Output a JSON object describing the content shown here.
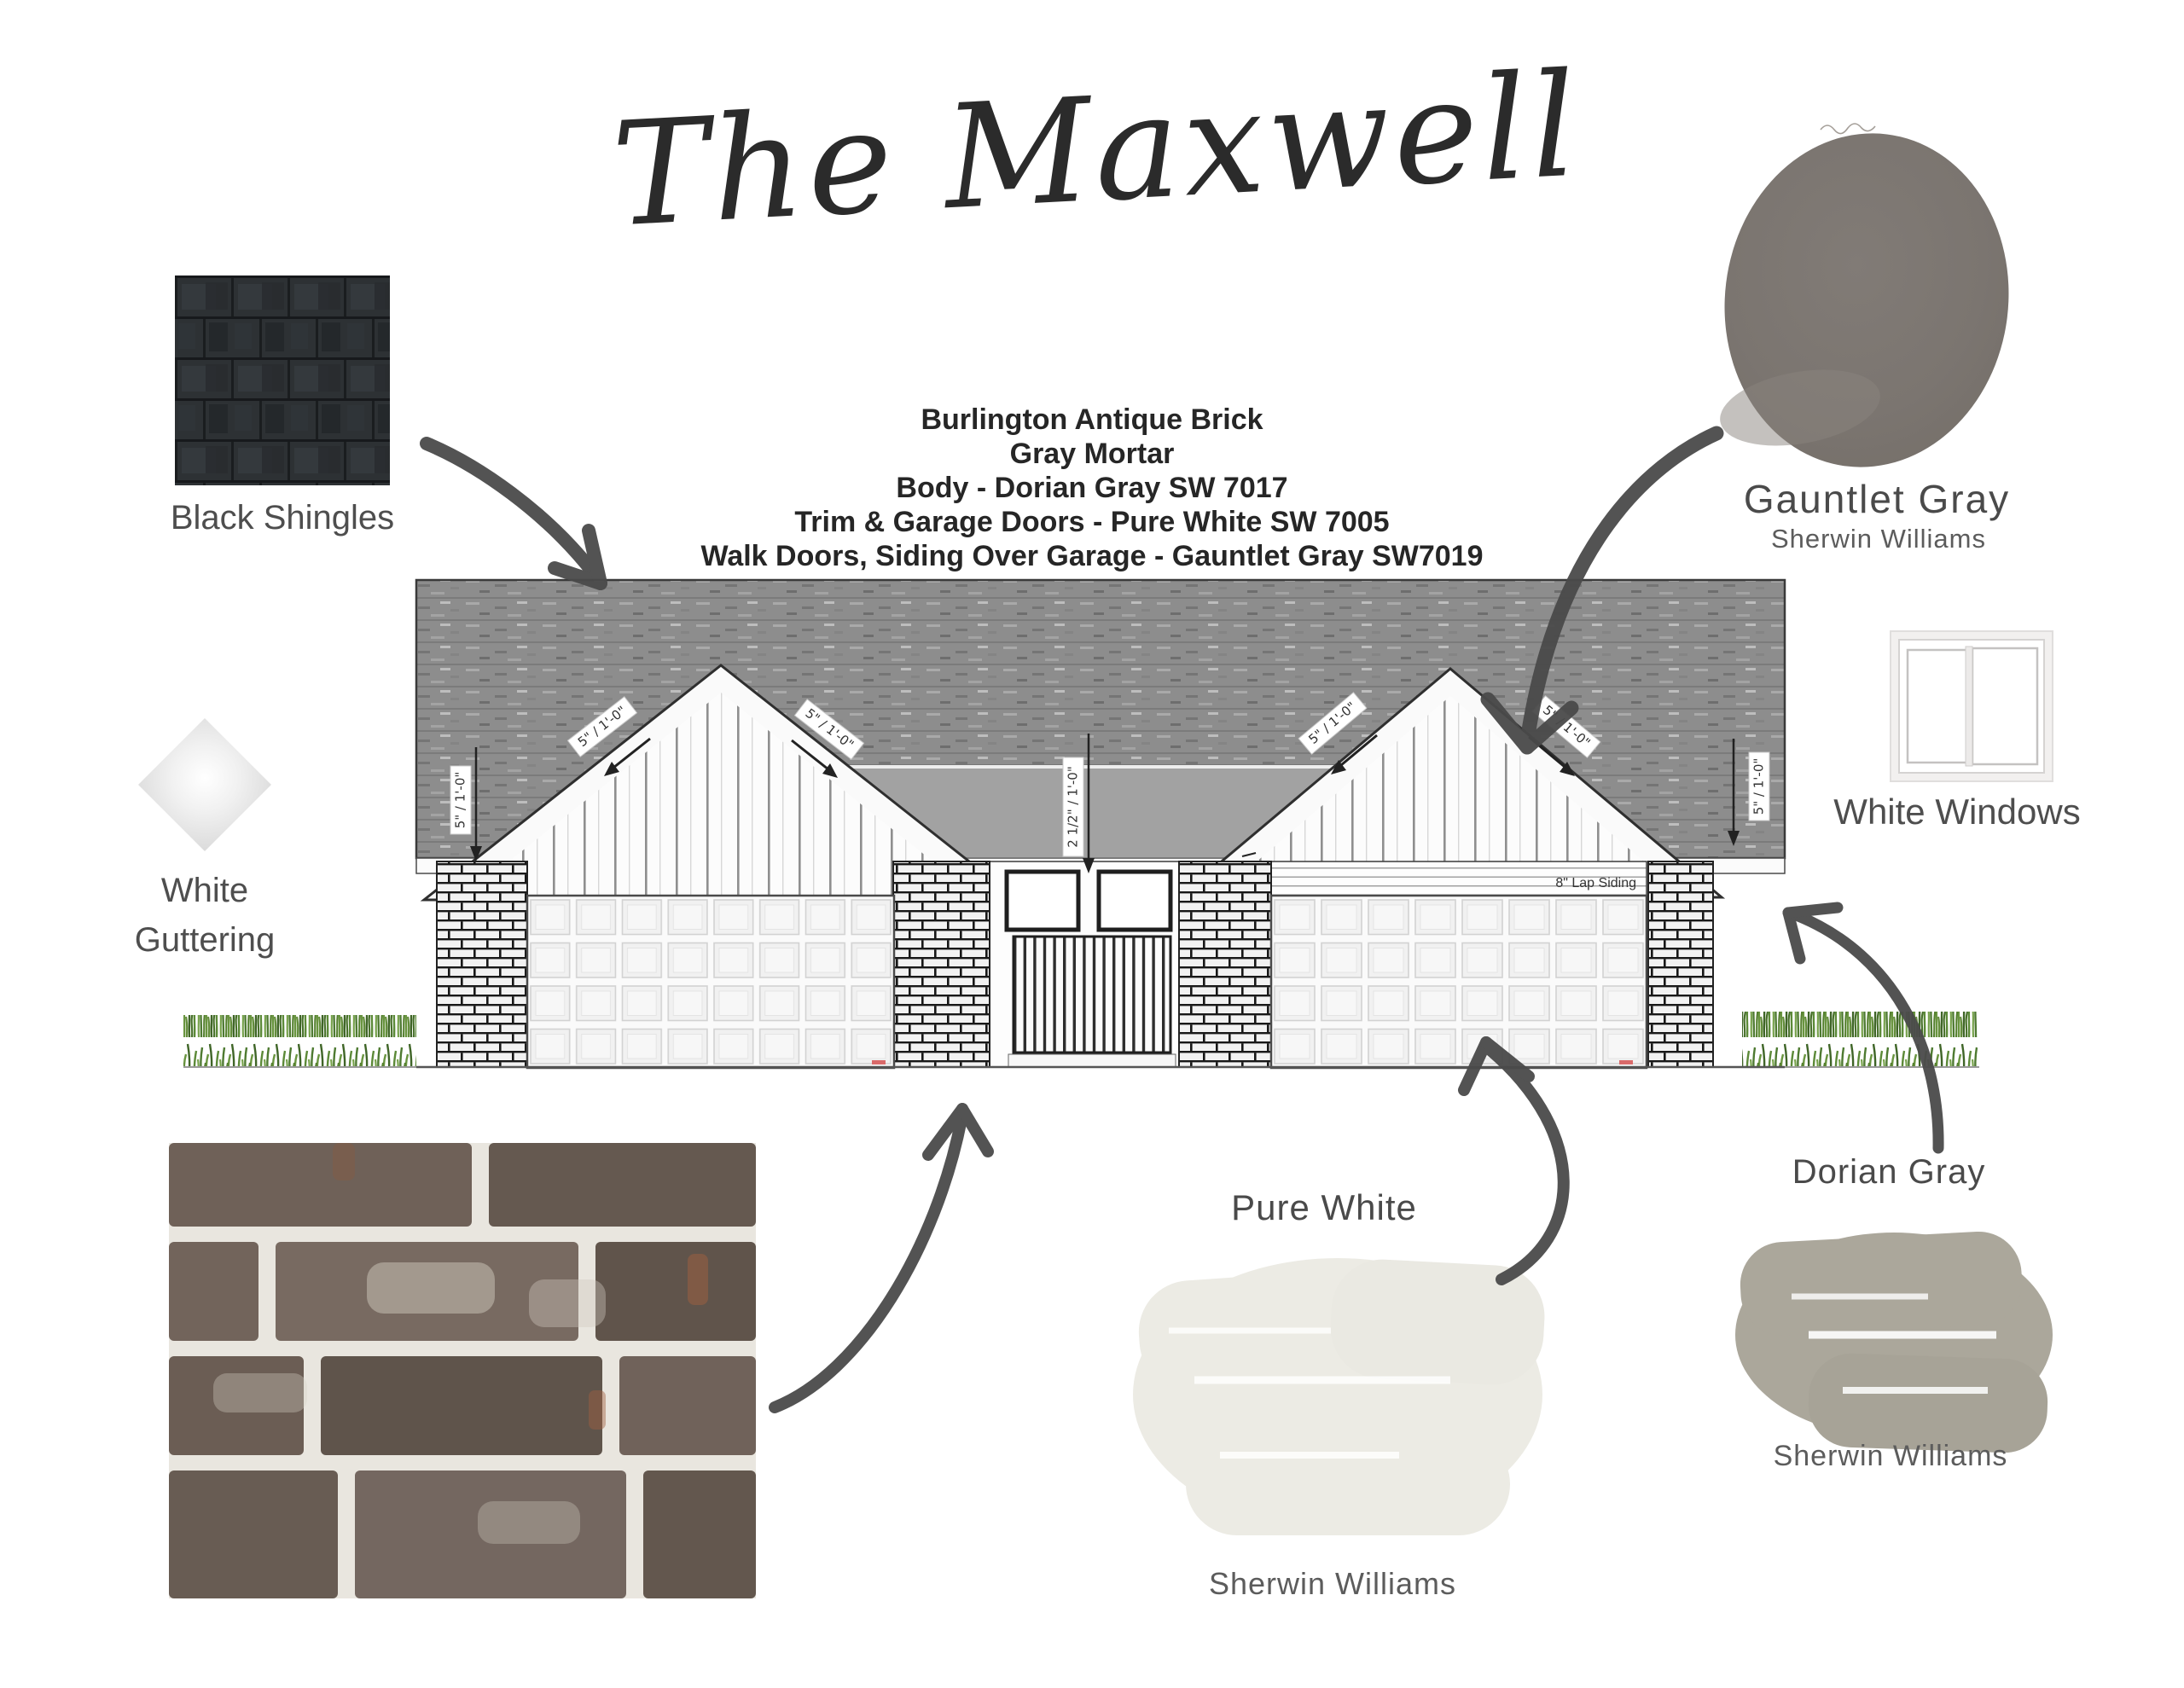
{
  "title": "The Maxwell",
  "specs": {
    "lines": [
      "Burlington Antique Brick",
      "Gray Mortar",
      "Body - Dorian Gray SW 7017",
      "Trim & Garage Doors - Pure White SW 7005",
      "Walk Doors, Siding Over Garage - Gauntlet Gray SW7019"
    ]
  },
  "materials": {
    "black_shingles": {
      "label": "Black Shingles"
    },
    "white_guttering": {
      "line1": "White",
      "line2": "Guttering"
    },
    "gauntlet_gray": {
      "name": "Gauntlet Gray",
      "brand": "Sherwin Williams",
      "hex": "#7b7570"
    },
    "white_windows": {
      "label": "White Windows"
    },
    "pure_white": {
      "name": "Pure White",
      "brand": "Sherwin Williams",
      "hex": "#ecebe4"
    },
    "dorian_gray": {
      "name": "Dorian Gray",
      "brand": "Sherwin Williams",
      "hex": "#aba79b"
    }
  },
  "elevation": {
    "pitch_label": "5\" / 1'-0\"",
    "center_dim_label": "2 1/2\" / 1'-0\"",
    "lap_siding_label": "8\" Lap Siding",
    "lap_dim_label": "1'-6\""
  }
}
